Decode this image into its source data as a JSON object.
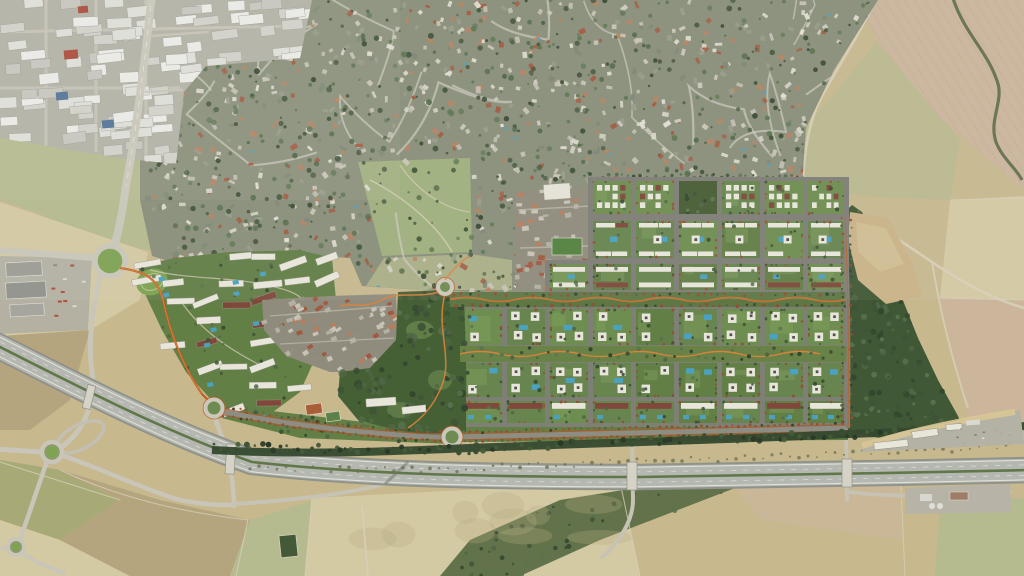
{
  "scene": {
    "type": "aerial-satellite-masterplan",
    "canvas": {
      "width": 1024,
      "height": 576
    },
    "seed": 7,
    "palette": {
      "baseField": "#c7b88c",
      "fieldLight": "#d4c9a2",
      "fieldDark": "#b3a47c",
      "fieldOlive": "#a6a873",
      "fieldGreen": "#b5ba8d",
      "fieldPink": "#cbb69b",
      "suburbGround": "#878d77",
      "roadLight": "#cdcabd",
      "industrialGround": "#b2b0a4",
      "devLawn": "#5e7c41",
      "devLawn2": "#6b8c4c",
      "devDark": "#42592f",
      "parkDark": "#415c30",
      "streetGray": "#7b7c72",
      "bldgWhite": "#eae7dc",
      "bldgRed": "#7d4335",
      "pool": "#46a0c0",
      "orangeRoad": "#c05a1f",
      "orangeLight": "#e07f35",
      "redTree": "#93492a",
      "treeDark": "#3a4f31",
      "motorwayCasing": "#8e9187",
      "motorwaySurface": "#b5b8b0",
      "medianGreen": "#5d7444",
      "stripe": "#e8e8e0",
      "treeBand": "#2f432a",
      "wood": "#3b5430",
      "wedgeTan": "#c9b386",
      "villageGround": "#8d8a7a",
      "hedge": "#5e6f45",
      "pathLight": "#d8d0b8",
      "ovalGreen": "#79a24a",
      "scrub": "#6c6f54",
      "bridge": "#d6d3c6"
    },
    "palette_arrays": {
      "tree_colors": [
        "#3a4f31",
        "#4b6340",
        "#2e4128",
        "#55714a"
      ],
      "house_colors": [
        "#c9c5b7",
        "#e3dfd3",
        "#b77f5d",
        "#a0553a",
        "#969a88",
        "#7b8370",
        "#c9c5b7",
        "#d8d4c8"
      ],
      "village_house_colors": [
        "#b3afa2",
        "#c7c3b5",
        "#a1553b",
        "#b87a58",
        "#8e8b7e"
      ],
      "warehouse_colors": [
        "#ecece8",
        "#e0e0da",
        "#d2d2ca",
        "#ecece8",
        "#dfdfd9",
        "#c6c6be"
      ]
    },
    "regions": {
      "suburb": {
        "polygon": [
          [
            140,
            0
          ],
          [
            878,
            0
          ],
          [
            834,
            70
          ],
          [
            806,
            128
          ],
          [
            802,
            186
          ],
          [
            756,
            198
          ],
          [
            700,
            181
          ],
          [
            598,
            180
          ],
          [
            590,
            188
          ],
          [
            592,
            292
          ],
          [
            545,
            296
          ],
          [
            470,
            292
          ],
          [
            420,
            290
          ],
          [
            362,
            286
          ],
          [
            350,
            258
          ],
          [
            300,
            255
          ],
          [
            240,
            257
          ],
          [
            172,
            262
          ],
          [
            152,
            256
          ],
          [
            140,
            200
          ]
        ]
      },
      "industrial": {
        "polygon": [
          [
            0,
            0
          ],
          [
            312,
            0
          ],
          [
            300,
            58
          ],
          [
            206,
            66
          ],
          [
            184,
            92
          ],
          [
            176,
            164
          ],
          [
            118,
            158
          ],
          [
            60,
            148
          ],
          [
            0,
            138
          ]
        ]
      },
      "meadow1": {
        "polygon": [
          [
            358,
            162
          ],
          [
            470,
            158
          ],
          [
            472,
            252
          ],
          [
            382,
            256
          ]
        ]
      },
      "meadow2": {
        "polygon": [
          [
            384,
            258
          ],
          [
            470,
            254
          ],
          [
            512,
            260
          ],
          [
            512,
            290
          ],
          [
            420,
            290
          ],
          [
            366,
            286
          ]
        ]
      },
      "village_east": {
        "polygon": [
          [
            514,
            192
          ],
          [
            590,
            188
          ],
          [
            592,
            290
          ],
          [
            516,
            290
          ]
        ]
      },
      "village_west": {
        "polygon": [
          [
            262,
            300
          ],
          [
            330,
            296
          ],
          [
            396,
            294
          ],
          [
            398,
            340
          ],
          [
            396,
            372
          ],
          [
            330,
            372
          ],
          [
            286,
            356
          ],
          [
            264,
            330
          ]
        ]
      },
      "western_cluster": {
        "polygon": [
          [
            138,
            266
          ],
          [
            175,
            258
          ],
          [
            230,
            252
          ],
          [
            300,
            250
          ],
          [
            332,
            258
          ],
          [
            336,
            300
          ],
          [
            318,
            352
          ],
          [
            300,
            392
          ],
          [
            262,
            420
          ],
          [
            224,
            414
          ],
          [
            186,
            372
          ],
          [
            162,
            330
          ],
          [
            146,
            296
          ]
        ]
      },
      "park_band": {
        "polygon": [
          [
            398,
            292
          ],
          [
            444,
            290
          ],
          [
            464,
            294
          ],
          [
            466,
            360
          ],
          [
            466,
            432
          ],
          [
            434,
            436
          ],
          [
            396,
            430
          ],
          [
            358,
            420
          ],
          [
            338,
            396
          ],
          [
            340,
            372
          ],
          [
            370,
            368
          ],
          [
            396,
            340
          ]
        ]
      },
      "south_strip": {
        "polygon": [
          [
            214,
            404
          ],
          [
            330,
            418
          ],
          [
            430,
            430
          ],
          [
            452,
            428
          ],
          [
            452,
            444
          ],
          [
            300,
            438
          ],
          [
            214,
            416
          ]
        ]
      },
      "east_woodland": {
        "polygon": [
          [
            838,
            218
          ],
          [
            852,
            205
          ],
          [
            862,
            212
          ],
          [
            872,
            232
          ],
          [
            886,
            262
          ],
          [
            902,
            298
          ],
          [
            918,
            338
          ],
          [
            938,
            380
          ],
          [
            958,
            416
          ],
          [
            966,
            436
          ],
          [
            935,
            440
          ],
          [
            880,
            438
          ],
          [
            848,
            432
          ],
          [
            843,
            330
          ],
          [
            840,
            260
          ]
        ]
      },
      "field_wedge": {
        "polygon": [
          [
            850,
            212
          ],
          [
            888,
            218
          ],
          [
            912,
            262
          ],
          [
            922,
            296
          ],
          [
            886,
            304
          ],
          [
            858,
            280
          ],
          [
            848,
            240
          ]
        ]
      },
      "hedge_band": {
        "polygon": [
          [
            440,
            576
          ],
          [
            470,
            540
          ],
          [
            560,
            500
          ],
          [
            700,
            478
          ],
          [
            735,
            488
          ],
          [
            600,
            540
          ],
          [
            520,
            576
          ]
        ]
      },
      "plow_field": {
        "polygon": [
          [
            858,
            0
          ],
          [
            1024,
            0
          ],
          [
            1024,
            190
          ],
          [
            940,
            118
          ],
          [
            878,
            42
          ]
        ]
      }
    },
    "grid": {
      "col_x": [
        464,
        507,
        550,
        593,
        636,
        679,
        722,
        765,
        808
      ],
      "col_w": 38,
      "east_col_w": 36,
      "rows": [
        {
          "y": 181,
          "h": 33,
          "c0": 3,
          "c1": 8,
          "style": "smallgrid",
          "park": [
            5
          ]
        },
        {
          "y": 221,
          "h": 37,
          "c0": 3,
          "c1": 8,
          "style": "mixed",
          "park": []
        },
        {
          "y": 264,
          "h": 26,
          "c0": 2,
          "c1": 8,
          "style": "slabpair",
          "park": []
        },
        {
          "y": 309,
          "h": 36,
          "c0": 0,
          "c1": 8,
          "style": "courtyard",
          "park": []
        },
        {
          "y": 363,
          "h": 34,
          "c0": 0,
          "c1": 8,
          "style": "courtyard",
          "park": []
        },
        {
          "y": 401,
          "h": 22,
          "c0": 0,
          "c1": 8,
          "style": "slab",
          "park": []
        }
      ],
      "boulevard": {
        "x0": 450,
        "x1": 848,
        "y": 292,
        "h": 15
      },
      "wavy_band": {
        "x0": 460,
        "x1": 848,
        "y": 346,
        "h": 16
      }
    },
    "roundabouts": {
      "north_gateway": {
        "x": 110,
        "y": 261,
        "r": 15
      },
      "west_dev": {
        "x": 214,
        "y": 408,
        "r": 8.5
      },
      "south_dev": {
        "x": 452,
        "y": 437,
        "r": 8.5
      },
      "park_dev": {
        "x": 445,
        "y": 287,
        "r": 7
      },
      "interchange_main": {
        "x": 52,
        "y": 452,
        "r": 10
      },
      "interchange_south": {
        "x": 16,
        "y": 547,
        "r": 8
      }
    },
    "motorway": {
      "center": "M -10,342 C 70,382 160,430 252,462 C 360,474 480,477 640,477 C 780,475 900,473 1030,470",
      "width": 22.5
    },
    "counts": {
      "suburb_houses": 680,
      "suburb_trees": 560,
      "suburb_pools": 16,
      "suburb_streets": 16,
      "industrial_units": 95,
      "cluster_pools": 12,
      "village_west_houses": 78,
      "village_east_houses": 64,
      "park_trees": 95,
      "wood_trees": 110,
      "strip_trees": 34,
      "cluster_trees": 46
    }
  }
}
